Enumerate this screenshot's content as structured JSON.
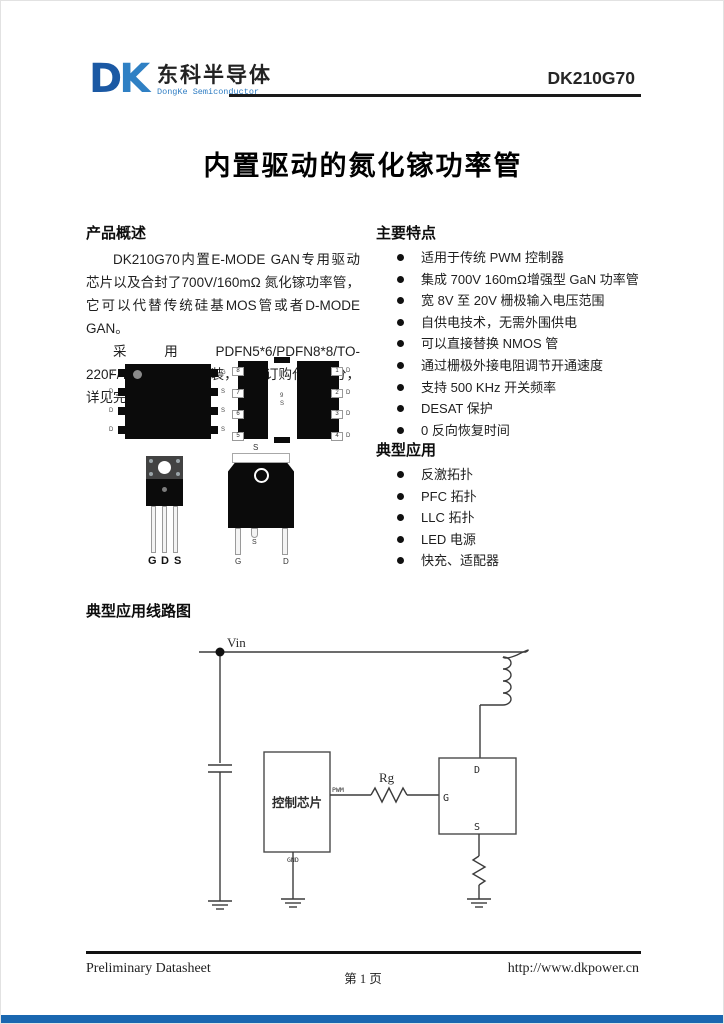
{
  "header": {
    "logo_d": "D",
    "logo_k": "K",
    "company_cn": "东科半导体",
    "company_en": "DongKe Semiconductor",
    "part_number": "DK210G70"
  },
  "title": {
    "text": "内置驱动的氮化镓功率管"
  },
  "overview": {
    "heading": "产品概述",
    "p1": "DK210G70内置E-MODE GAN专用驱动芯片以及合封了700V/160mΩ 氮化镓功率管，它可以代替传统硅基MOS管或者D-MODE GAN。",
    "p2": "采用PDFN5*6/PDFN8*8/TO-220F/TO252-4R等封装，通过订购代码区分，详见完整版规格书。"
  },
  "features": {
    "heading": "主要特点",
    "items": [
      "适用于传统 PWM 控制器",
      "集成 700V 160mΩ增强型 GaN 功率管",
      "宽 8V 至 20V 栅极输入电压范围",
      "自供电技术，无需外围供电",
      "可以直接替换 NMOS 管",
      "通过栅极外接电阻调节开通速度",
      "支持 500 KHz 开关频率",
      "DESAT 保护",
      "0 反向恢复时间"
    ]
  },
  "applications": {
    "heading": "典型应用",
    "items": [
      "反激拓扑",
      "PFC 拓扑",
      "LLC 拓扑",
      "LED 电源",
      "快充、适配器"
    ]
  },
  "packages": {
    "pdfn_top": {
      "left_pins": [
        "D",
        "D",
        "D",
        "D"
      ],
      "right_pins": [
        "G",
        "S",
        "S",
        "S"
      ]
    },
    "pdfn_bottom": {
      "left_pads": [
        "8",
        "7",
        "6",
        "5"
      ],
      "right_pads": [
        "1",
        "2",
        "3",
        "4"
      ],
      "right_letters": [
        "D",
        "D",
        "D",
        "D"
      ],
      "center_top": "9",
      "center_bottom": "S"
    },
    "to220": {
      "pins": [
        "G",
        "D",
        "S"
      ]
    },
    "to252": {
      "tab": "S",
      "pin_g": "G",
      "pin_s": "S",
      "pin_d": "D"
    }
  },
  "circuit": {
    "heading": "典型应用线路图",
    "vin": "Vin",
    "chip": "控制芯片",
    "pwm": "PWM",
    "gnd": "GND",
    "rg": "Rg",
    "pin_d": "D",
    "pin_g": "G",
    "pin_s": "S"
  },
  "footer": {
    "left": "Preliminary Datasheet",
    "center": "第 1 页",
    "right": "http://www.dkpower.cn"
  },
  "colors": {
    "accent_blue": "#1a67b0",
    "logo_dark_blue": "#1b59a4",
    "logo_light_blue": "#2f80c4"
  }
}
